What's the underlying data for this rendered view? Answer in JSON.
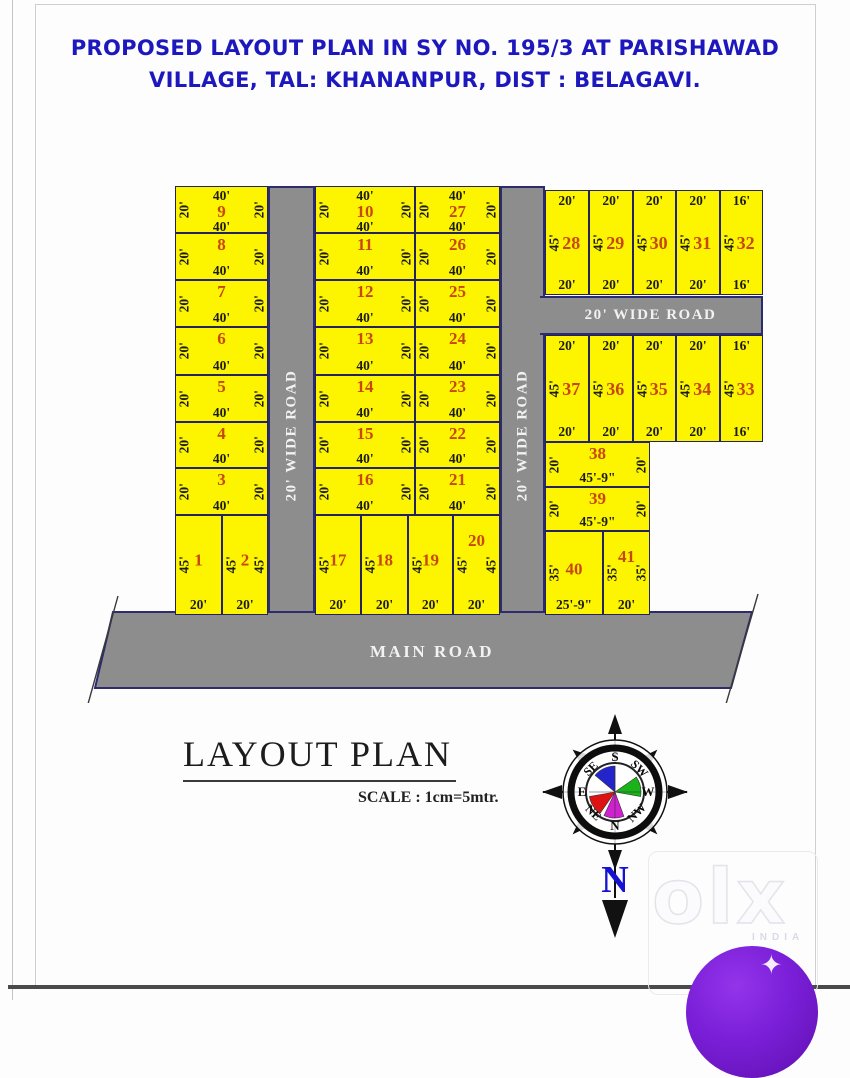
{
  "title": {
    "line1": "PROPOSED LAYOUT PLAN IN SY NO. 195/3 AT PARISHAWAD",
    "line2": "VILLAGE, TAL: KHANANPUR, DIST : BELAGAVI."
  },
  "roads": {
    "left_vertical": "20' WIDE ROAD",
    "right_vertical": "20' WIDE ROAD",
    "cross": "20' WIDE ROAD",
    "main": "MAIN ROAD"
  },
  "legend": {
    "title": "LAYOUT PLAN",
    "scale": "SCALE : 1cm=5mtr."
  },
  "compass": {
    "top": "S",
    "top_right": "SW",
    "right": "W",
    "bottom_right": "NW",
    "bottom": "N",
    "bottom_left": "NE",
    "left": "E",
    "top_left": "SE",
    "pointer": "N"
  },
  "watermark": {
    "logo": "olx",
    "country": "INDIA",
    "sparkle": "✦"
  },
  "colors": {
    "plot_fill": "#fdf400",
    "plot_border": "#23235f",
    "plot_number": "#c8470f",
    "road_gray": "#8d8d8d",
    "title_blue": "#1d18bd",
    "watermark_purple": "#7a1fd8"
  },
  "plots": [
    {
      "n": "9",
      "x": 175,
      "y": 186,
      "w": 93,
      "h": 47,
      "t": "40'",
      "b": "40'",
      "l": "20'",
      "r": "20'",
      "cls": "row"
    },
    {
      "n": "8",
      "x": 175,
      "y": 233,
      "w": 93,
      "h": 47,
      "b": "40'",
      "l": "20'",
      "r": "20'",
      "cls": "row"
    },
    {
      "n": "7",
      "x": 175,
      "y": 280,
      "w": 93,
      "h": 47,
      "b": "40'",
      "l": "20'",
      "r": "20'",
      "cls": "row"
    },
    {
      "n": "6",
      "x": 175,
      "y": 327,
      "w": 93,
      "h": 48,
      "b": "40'",
      "l": "20'",
      "r": "20'",
      "cls": "row"
    },
    {
      "n": "5",
      "x": 175,
      "y": 375,
      "w": 93,
      "h": 47,
      "b": "40'",
      "l": "20'",
      "r": "20'",
      "cls": "row"
    },
    {
      "n": "4",
      "x": 175,
      "y": 422,
      "w": 93,
      "h": 46,
      "b": "40'",
      "l": "20'",
      "r": "20'",
      "cls": "row"
    },
    {
      "n": "3",
      "x": 175,
      "y": 468,
      "w": 93,
      "h": 47,
      "b": "40'",
      "l": "20'",
      "r": "20'",
      "cls": "row"
    },
    {
      "n": "1",
      "x": 175,
      "y": 515,
      "w": 47,
      "h": 100,
      "b": "20'",
      "l": "45'",
      "cls": "tall"
    },
    {
      "n": "2",
      "x": 222,
      "y": 515,
      "w": 46,
      "h": 100,
      "b": "20'",
      "l": "45'",
      "r": "45'",
      "cls": "tall"
    },
    {
      "n": "10",
      "x": 315,
      "y": 186,
      "w": 100,
      "h": 47,
      "t": "40'",
      "b": "40'",
      "l": "20'",
      "r": "20'",
      "cls": "row"
    },
    {
      "n": "11",
      "x": 315,
      "y": 233,
      "w": 100,
      "h": 47,
      "b": "40'",
      "l": "20'",
      "r": "20'",
      "cls": "row"
    },
    {
      "n": "12",
      "x": 315,
      "y": 280,
      "w": 100,
      "h": 47,
      "b": "40'",
      "l": "20'",
      "r": "20'",
      "cls": "row"
    },
    {
      "n": "13",
      "x": 315,
      "y": 327,
      "w": 100,
      "h": 48,
      "b": "40'",
      "l": "20'",
      "r": "20'",
      "cls": "row"
    },
    {
      "n": "14",
      "x": 315,
      "y": 375,
      "w": 100,
      "h": 47,
      "b": "40'",
      "l": "20'",
      "r": "20'",
      "cls": "row"
    },
    {
      "n": "15",
      "x": 315,
      "y": 422,
      "w": 100,
      "h": 46,
      "b": "40'",
      "l": "20'",
      "r": "20'",
      "cls": "row"
    },
    {
      "n": "16",
      "x": 315,
      "y": 468,
      "w": 100,
      "h": 47,
      "b": "40'",
      "l": "20'",
      "r": "20'",
      "cls": "row"
    },
    {
      "n": "17",
      "x": 315,
      "y": 515,
      "w": 46,
      "h": 100,
      "b": "20'",
      "l": "45'",
      "cls": "tall"
    },
    {
      "n": "18",
      "x": 361,
      "y": 515,
      "w": 47,
      "h": 100,
      "b": "20'",
      "l": "45'",
      "cls": "tall"
    },
    {
      "n": "19",
      "x": 408,
      "y": 515,
      "w": 45,
      "h": 100,
      "b": "20'",
      "l": "45'",
      "cls": "tall"
    },
    {
      "n": "20",
      "x": 453,
      "y": 515,
      "w": 47,
      "h": 100,
      "b": "20'",
      "l": "45'",
      "r": "45'",
      "cls": "tall top"
    },
    {
      "n": "27",
      "x": 415,
      "y": 186,
      "w": 85,
      "h": 47,
      "t": "40'",
      "b": "40'",
      "l": "20'",
      "r": "20'",
      "cls": "row"
    },
    {
      "n": "26",
      "x": 415,
      "y": 233,
      "w": 85,
      "h": 47,
      "b": "40'",
      "l": "20'",
      "r": "20'",
      "cls": "row"
    },
    {
      "n": "25",
      "x": 415,
      "y": 280,
      "w": 85,
      "h": 47,
      "b": "40'",
      "l": "20'",
      "r": "20'",
      "cls": "row"
    },
    {
      "n": "24",
      "x": 415,
      "y": 327,
      "w": 85,
      "h": 48,
      "b": "40'",
      "l": "20'",
      "r": "20'",
      "cls": "row"
    },
    {
      "n": "23",
      "x": 415,
      "y": 375,
      "w": 85,
      "h": 47,
      "b": "40'",
      "l": "20'",
      "r": "20'",
      "cls": "row"
    },
    {
      "n": "22",
      "x": 415,
      "y": 422,
      "w": 85,
      "h": 46,
      "b": "40'",
      "l": "20'",
      "r": "20'",
      "cls": "row"
    },
    {
      "n": "21",
      "x": 415,
      "y": 468,
      "w": 85,
      "h": 47,
      "b": "40'",
      "l": "20'",
      "r": "20'",
      "cls": "row"
    },
    {
      "n": "28",
      "x": 545,
      "y": 190,
      "w": 44,
      "h": 105,
      "t": "20'",
      "b": "20'",
      "l": "45'",
      "cls": "rb"
    },
    {
      "n": "29",
      "x": 589,
      "y": 190,
      "w": 44,
      "h": 105,
      "t": "20'",
      "b": "20'",
      "l": "45'",
      "cls": "rb"
    },
    {
      "n": "30",
      "x": 633,
      "y": 190,
      "w": 43,
      "h": 105,
      "t": "20'",
      "b": "20'",
      "l": "45'",
      "cls": "rb"
    },
    {
      "n": "31",
      "x": 676,
      "y": 190,
      "w": 44,
      "h": 105,
      "t": "20'",
      "b": "20'",
      "l": "45'",
      "cls": "rb"
    },
    {
      "n": "32",
      "x": 720,
      "y": 190,
      "w": 43,
      "h": 105,
      "t": "16'",
      "b": "16'",
      "l": "45'",
      "cls": "rb"
    },
    {
      "n": "37",
      "x": 545,
      "y": 335,
      "w": 44,
      "h": 107,
      "t": "20'",
      "b": "20'",
      "l": "45'",
      "cls": "rb"
    },
    {
      "n": "36",
      "x": 589,
      "y": 335,
      "w": 44,
      "h": 107,
      "t": "20'",
      "b": "20'",
      "l": "45'",
      "cls": "rb"
    },
    {
      "n": "35",
      "x": 633,
      "y": 335,
      "w": 43,
      "h": 107,
      "t": "20'",
      "b": "20'",
      "l": "45'",
      "cls": "rb"
    },
    {
      "n": "34",
      "x": 676,
      "y": 335,
      "w": 44,
      "h": 107,
      "t": "20'",
      "b": "20'",
      "l": "45'",
      "cls": "rb"
    },
    {
      "n": "33",
      "x": 720,
      "y": 335,
      "w": 43,
      "h": 107,
      "t": "16'",
      "b": "16'",
      "l": "45'",
      "cls": "rb"
    },
    {
      "n": "38",
      "x": 545,
      "y": 442,
      "w": 105,
      "h": 45,
      "b": "45'-9\"",
      "l": "20'",
      "r": "20'",
      "cls": "row"
    },
    {
      "n": "39",
      "x": 545,
      "y": 487,
      "w": 105,
      "h": 44,
      "b": "45'-9\"",
      "l": "20'",
      "r": "20'",
      "cls": "row"
    },
    {
      "n": "40",
      "x": 545,
      "y": 531,
      "w": 58,
      "h": 84,
      "b": "25'-9\"",
      "l": "35'",
      "cls": "tall"
    },
    {
      "n": "41",
      "x": 603,
      "y": 531,
      "w": 47,
      "h": 84,
      "b": "20'",
      "l": "35'",
      "r": "35'",
      "cls": "tall top"
    }
  ]
}
